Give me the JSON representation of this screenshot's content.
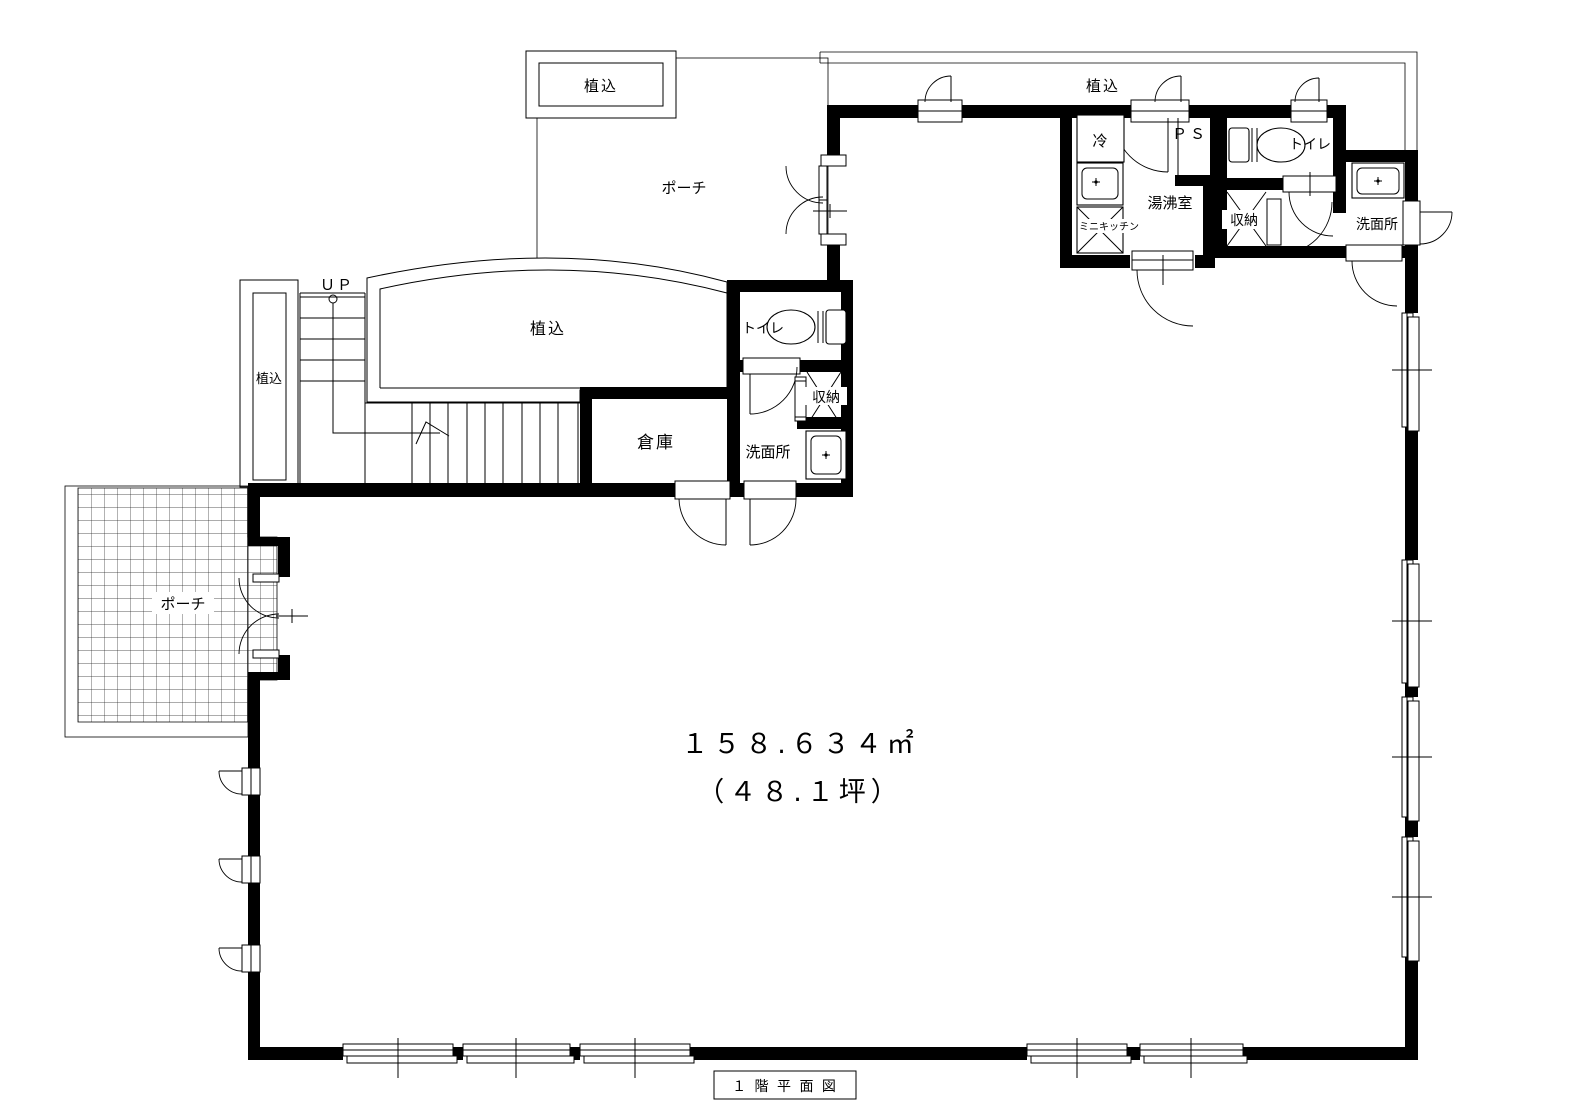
{
  "colors": {
    "line": "#000000",
    "background": "#ffffff"
  },
  "floor_plan": {
    "title": "１ 階 平 面 図",
    "area_m2": "１５８.６３４㎡",
    "area_tsubo": "（４８.１坪）"
  },
  "labels": {
    "planting": "植込",
    "porch": "ポーチ",
    "up": "ＵＰ",
    "fridge": "冷",
    "pipe_space": "ＰＳ",
    "toilet": "トイレ",
    "hot_water_room": "湯沸室",
    "mini_kitchen": "ミニキッチン",
    "storage": "収納",
    "washroom": "洗面所",
    "warehouse": "倉庫"
  }
}
